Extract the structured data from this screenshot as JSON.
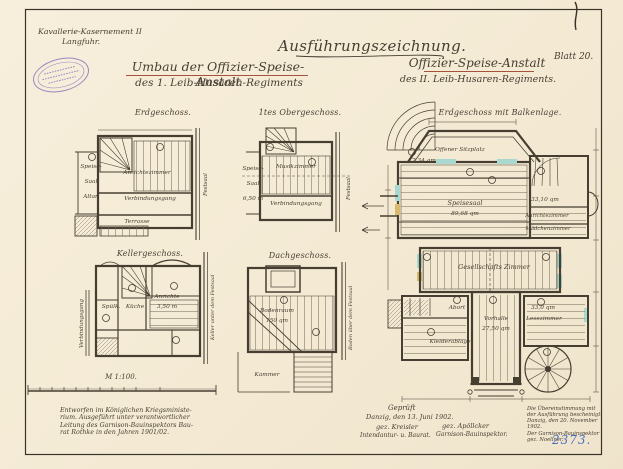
{
  "colors": {
    "paper": "#f5ecd8",
    "ink": "#463e31",
    "underline_red": "#a5513c",
    "stamp_purple": "#8f74bb",
    "archive_blue": "#4a6fc0",
    "window_teal": "#a8d8cf"
  },
  "header": {
    "unit_line1": "Kavallerie-Kasernement II",
    "unit_line2": "Langfuhr.",
    "main_title": "Ausführungszeichnung.",
    "left_title_line1": "Umbau der Offizier-Speise-Anstalt",
    "left_title_line2": "des 1. Leib-Husaren-Regiments",
    "right_title_line1": "Offizier-Speise-Anstalt",
    "right_title_line2": "des II. Leib-Husaren-Regiments.",
    "sheet_label": "Blatt 20."
  },
  "plans": {
    "erdgeschoss": {
      "title": "Erdgeschoss.",
      "label_speise": "Speise-",
      "label_saal": "Saal",
      "label_altan": "Altan",
      "label_anrichtezimmer": "Anrichtezimmer",
      "label_verbindungsgang": "Verbindungsgang",
      "label_festsaal": "Festsaal",
      "label_terrasse": "Terrasse"
    },
    "obergeschoss": {
      "title": "1tes Obergeschoss.",
      "label_speise": "Speise-",
      "label_saal": "Saal",
      "label_mass": "6,50 m",
      "label_musikzimmer": "Musikzimmer",
      "label_verbindungsgang": "Verbindungsgang",
      "label_festsaal": "Festsaal"
    },
    "kellergeschoss": {
      "title": "Kellergeschoss.",
      "label_spuelkueche": "Spülk.",
      "label_kueche": "Küche",
      "label_anrichte": "Anrichte",
      "label_mass": "3,50 m",
      "label_verbindungsgang": "Verbindungsgang",
      "label_keller_rechts": "Keller unter dem Festsaal",
      "scale_label": "M 1:100."
    },
    "dachgeschoss": {
      "title": "Dachgeschoss.",
      "label_bodenraum": "Bodenraum",
      "label_area": "150 qm",
      "label_kammer": "Kammer",
      "label_boden_rechts": "Boden über dem Festsaal"
    },
    "hauptplan": {
      "title": "Erdgeschoss mit Balkenlage.",
      "label_sitzplatz": "Offener Sitzplatz",
      "area_sitzplatz": "17,34 qm",
      "label_speisesaal": "Speisesaal",
      "area_speisesaal": "89,68 qm",
      "area_anrichte": "33,10 qm",
      "label_anrichtezimmer": "Anrichtezimmer",
      "label_maedchenzimmer": "Mädchenzimmer",
      "label_gesellschaftszimmer": "Gesellschafts Zimmer",
      "label_abort": "Abort",
      "label_kleiderablage": "Kleiderablage",
      "label_vorhalle": "Vorhalle",
      "area_vorhalle": "27,50 qm",
      "area_lesezimmer": "33,0 qm",
      "label_lesezimmer": "Lesezimmer"
    }
  },
  "footer": {
    "left_note_line1": "Entworfen im Königlichen Kriegsministe-",
    "left_note_line2": "rium. Ausgeführt unter verantwortlicher",
    "left_note_line3": "Leitung des Garnison-Bauinspektors Bau-",
    "left_note_line4": "rat Rothke in den Jahren 1901/02.",
    "approval_line1": "Geprüft",
    "approval_line2": "Danzig, den 13. Juni 1902.",
    "signature1": "gez. Kreisler",
    "signature1_role": "Intendantur- u. Baurat.",
    "signature2": "gez. Apöllcker",
    "signature2_role": "Garnison-Bauinspektor.",
    "cert_line1": "Die Übereinstimmung mit",
    "cert_line2": "der Ausführung bescheinigt.",
    "cert_line3": "Danzig, den 20. November 1902.",
    "cert_line4": "Der Garnison-Bauinspektor",
    "cert_line5": "gez. Noellner.",
    "archive_number": "2373."
  }
}
